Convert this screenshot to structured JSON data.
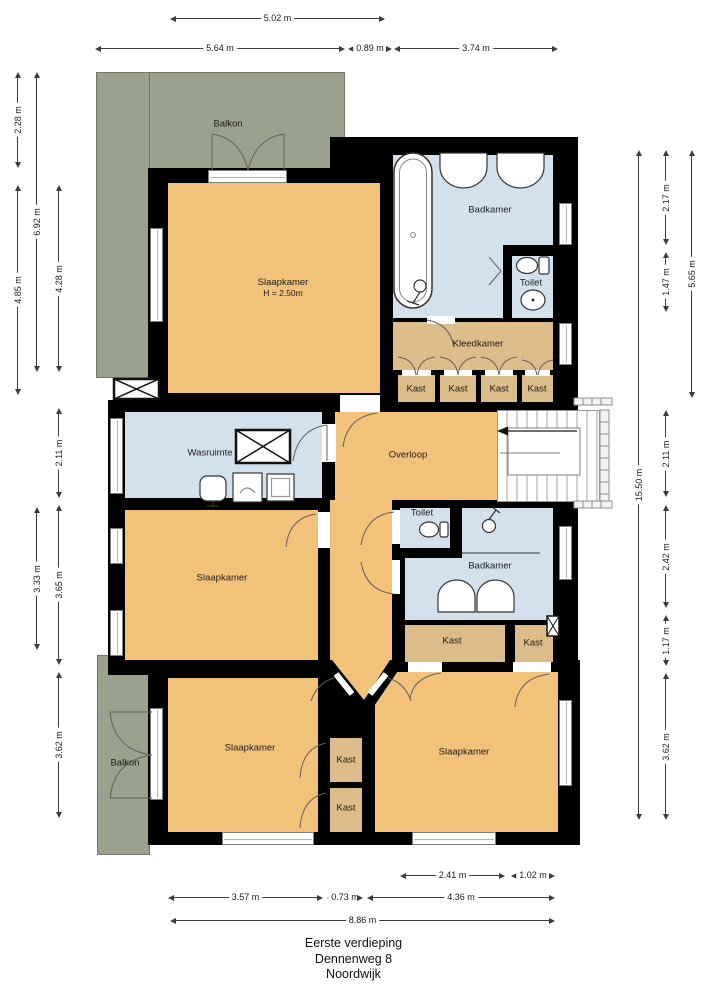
{
  "title": {
    "line1": "Eerste verdieping",
    "line2": "Dennenweg 8",
    "line3": "Noordwijk"
  },
  "rooms": {
    "balkon_top": "Balkon",
    "slaapkamer_tl": "Slaapkamer",
    "slaapkamer_tl_h": "H = 2.50m",
    "badkamer_tr": "Badkamer",
    "toilet_tr": "Toilet",
    "kleedkamer": "Kleedkamer",
    "kast_1": "Kast",
    "kast_2": "Kast",
    "kast_3": "Kast",
    "kast_4": "Kast",
    "wasruimte": "Wasruimte",
    "overloop": "Overloop",
    "slaapkamer_ml": "Slaapkamer",
    "toilet_mid": "Toilet",
    "badkamer_mid": "Badkamer",
    "kast_mid_left": "Kast",
    "kast_mid_right": "Kast",
    "slaapkamer_bl": "Slaapkamer",
    "balkon_bottom": "Balkon",
    "kast_bottom_1": "Kast",
    "kast_bottom_2": "Kast",
    "slaapkamer_br": "Slaapkamer"
  },
  "dimensions": {
    "top": [
      "5.02 m",
      "5.64 m",
      "0.89 m",
      "3.74 m"
    ],
    "left": [
      "2.28 m",
      "4.85 m",
      "6.92 m",
      "3.33 m",
      "4.28 m",
      "2.11 m",
      "3.65 m",
      "3.62 m"
    ],
    "right": [
      "15.50 m",
      "2.17 m",
      "1.47 m",
      "2.11 m",
      "2.42 m",
      "1.17 m",
      "3.62 m",
      "5.65 m"
    ],
    "bottom": [
      "2.41 m",
      "1.02 m",
      "3.57 m",
      "0.73 m",
      "4.36 m",
      "8.86 m"
    ]
  },
  "fixtures": [
    "bathtub-icon",
    "sink-icon",
    "toilet-icon",
    "bidet-icon",
    "shower-icon",
    "washing-machine-icon",
    "laundry-sink-icon",
    "shaft-cross-icon",
    "stairs-icon",
    "railing",
    "door-arc",
    "french-doors"
  ],
  "colors": {
    "room_orange": "#f2c17a",
    "room_tan": "#dcbc88",
    "room_blue": "#d3e1ed",
    "balcony_green": "#9aa18c",
    "wall": "#000000",
    "dim": "#3c3c3c"
  }
}
